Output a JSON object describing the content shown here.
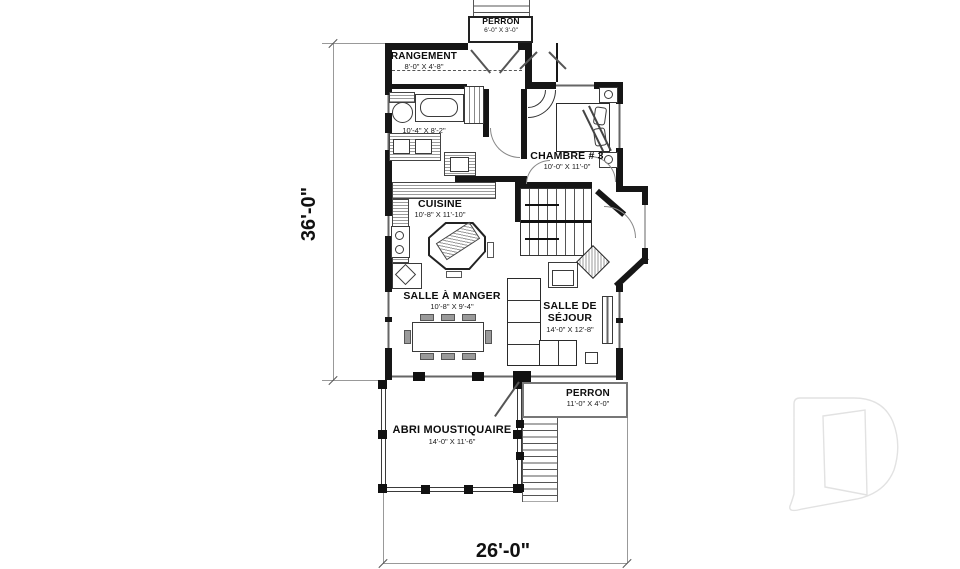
{
  "rooms": {
    "perron_top": {
      "name": "PERRON",
      "dims": "6'-0\" X 3'-0\""
    },
    "rangement": {
      "name": "RANGEMENT",
      "dims": "8'-0\" X 4'-8\""
    },
    "salle_de_bain": {
      "dims": "10'-4\" X 8'-2\""
    },
    "chambre_3": {
      "name": "CHAMBRE # 3",
      "dims": "10'-0\" X 11'-0\""
    },
    "cuisine": {
      "name": "CUISINE",
      "dims": "10'-8\" X 11'-10\""
    },
    "salle_a_manger": {
      "name": "SALLE À MANGER",
      "dims": "10'-8\" X 9'-4\""
    },
    "salle_de_sejour": {
      "name": "SALLE DE SÉJOUR",
      "dims": "14'-0\" X 12'-8\""
    },
    "perron_bas": {
      "name": "PERRON",
      "dims": "11'-0\" X 4'-0\""
    },
    "abri_moustiquaire": {
      "name": "ABRI MOUSTIQUAIRE",
      "dims": "14'-0\" X 11'-6\""
    }
  },
  "dimensions": {
    "overall_depth": "36'-0\"",
    "overall_width": "26'-0\""
  },
  "watermark": {
    "logo": "drummond-d-logo"
  },
  "colors": {
    "wall": "#161616",
    "background": "#ffffff",
    "hatch": "#9a9a9a",
    "dimension_line": "#999999",
    "watermark_outline": "#e2e2e2",
    "furniture_outline": "#2a2a2a",
    "chair_fill": "#9a9a9a"
  }
}
